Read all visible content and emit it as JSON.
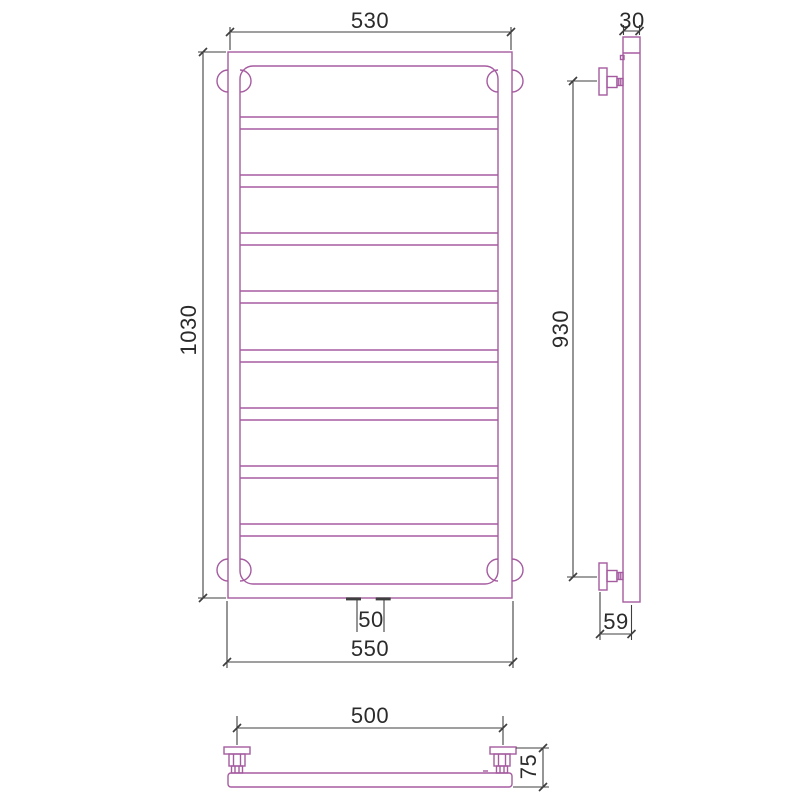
{
  "title": "Heated towel rail (ladder type) dimensioned technical drawing, three views",
  "colors": {
    "background": "#ffffff",
    "drawing_outline": "#a55ba0",
    "dimension_line": "#3f3f3f",
    "dimension_text": "#2b2b2b"
  },
  "views": {
    "front": {
      "dim_width_top": "530",
      "dim_height": "1030",
      "dim_connection_spacing": "50",
      "dim_width_bottom": "550",
      "rung_count": 8
    },
    "side": {
      "dim_tube_width": "30",
      "dim_bracket_span": "930",
      "dim_wall_offset": "59"
    },
    "bottom": {
      "dim_bracket_spacing": "500",
      "dim_depth": "75"
    }
  }
}
